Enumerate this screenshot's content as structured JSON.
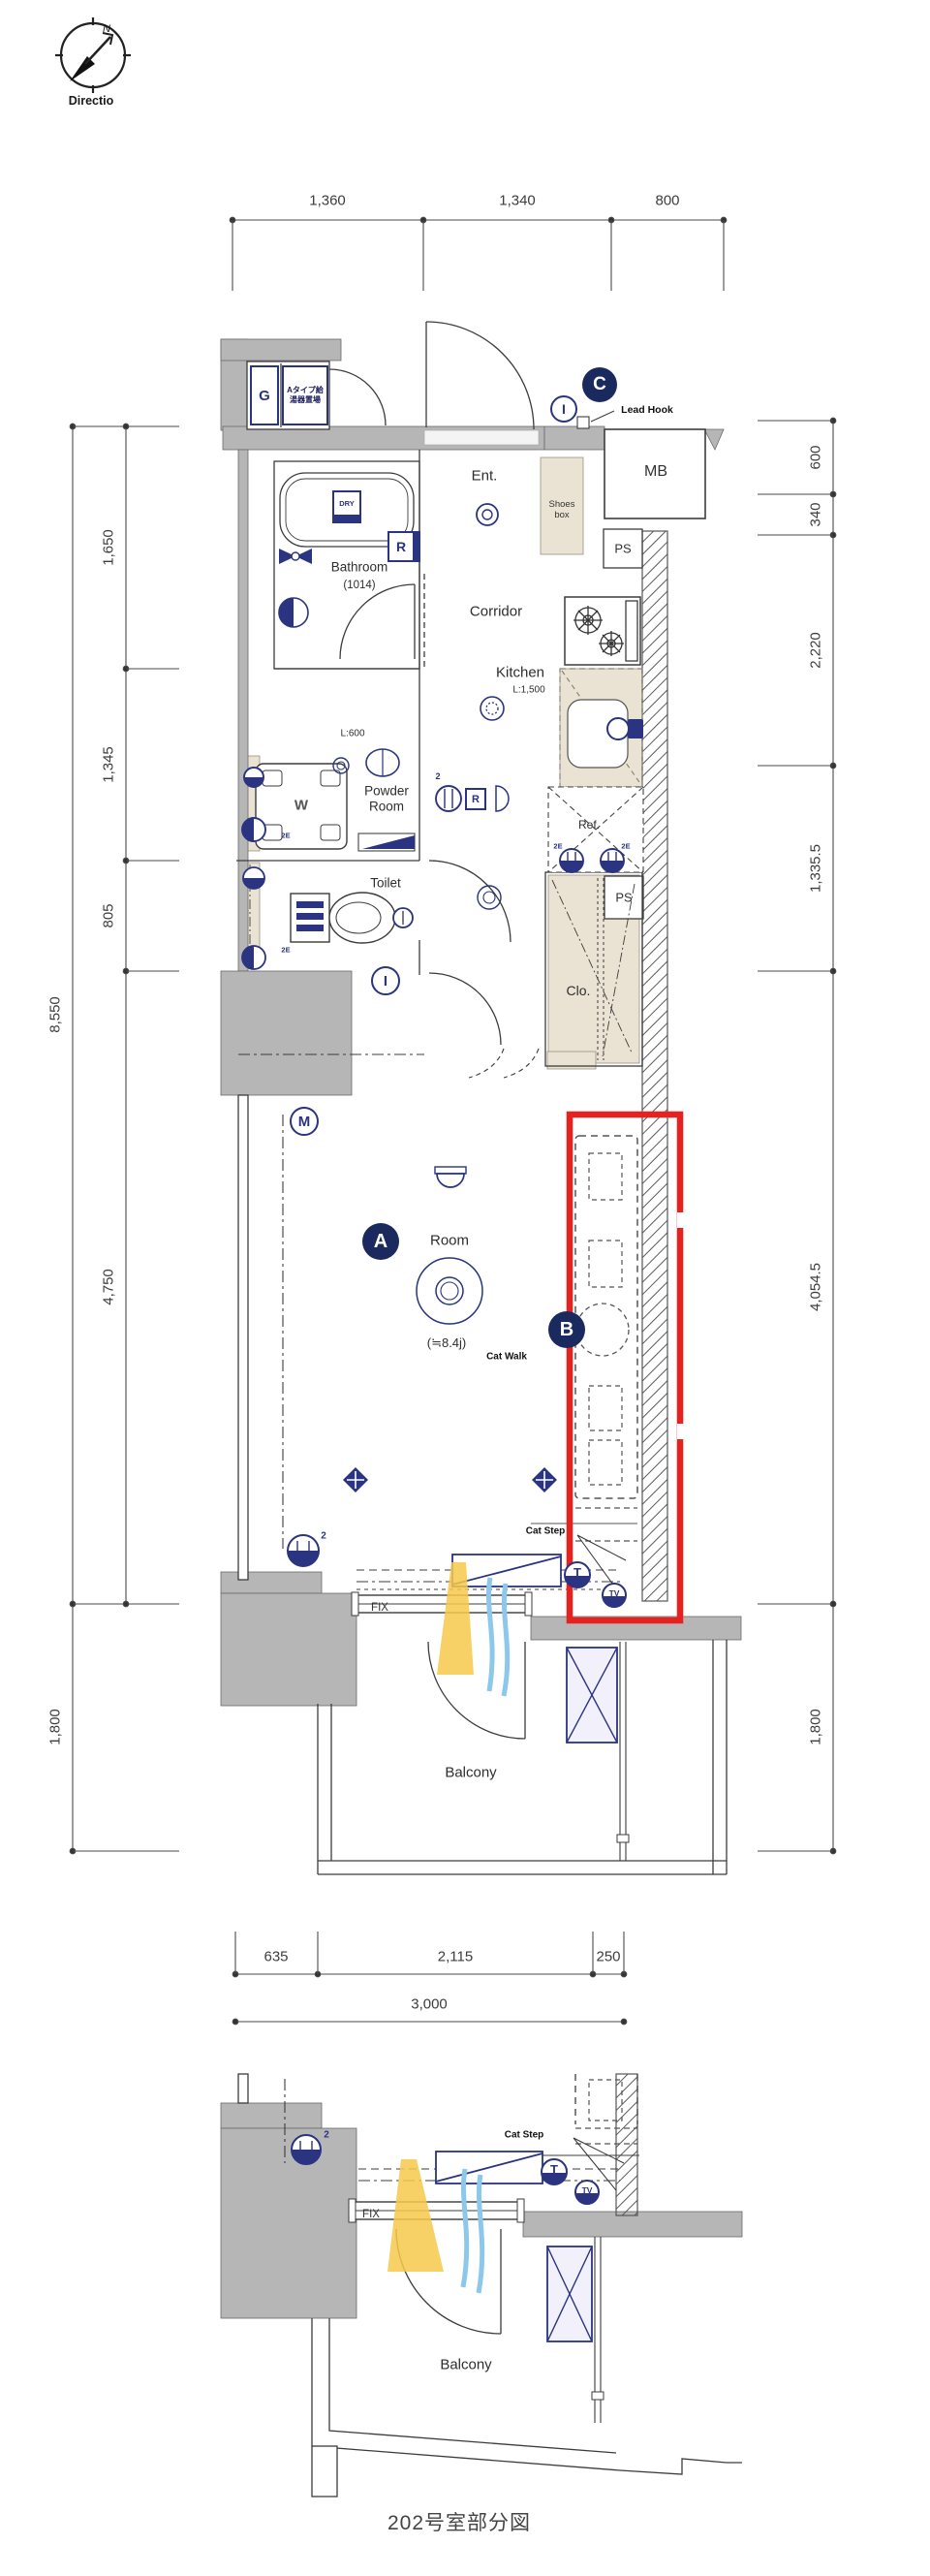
{
  "compass": {
    "label": "Directio",
    "north": "N"
  },
  "dims": {
    "top": [
      "1,360",
      "1,340",
      "800"
    ],
    "left_inner": [
      "1,650",
      "1,345",
      "805",
      "4,750"
    ],
    "left_outer": [
      "8,550",
      "1,800"
    ],
    "right": [
      "600",
      "340",
      "2,220",
      "1,335.5",
      "4,054.5",
      "1,800"
    ],
    "bottom": [
      "635",
      "2,115",
      "250"
    ],
    "bottom_total": "3,000"
  },
  "markers": {
    "a": "A",
    "b": "B",
    "c": "C",
    "m": "M",
    "i": "I",
    "t": "T",
    "tv": "TV"
  },
  "boxes": {
    "g": "G",
    "heater": "Aタイプ給湯器置場",
    "dry": "DRY",
    "r": "R",
    "w": "W",
    "mb": "MB",
    "ps": "PS",
    "e2": "2E",
    "fix": "FIX",
    "sup2": "2"
  },
  "rooms": {
    "ent": "Ent.",
    "shoes": "Shoes box",
    "bathroom": "Bathroom",
    "bathroom_size": "(1014)",
    "corridor": "Corridor",
    "kitchen": "Kitchen",
    "kitchen_level": "L:1,500",
    "washer_level": "L:600",
    "powder": "Powder Room",
    "toilet": "Toilet",
    "ref": "Ref.",
    "clo": "Clo.",
    "room": "Room",
    "room_size": "(≒8.4j)",
    "balcony": "Balcony"
  },
  "annotations": {
    "lead_hook": "Lead Hook",
    "cat_walk": "Cat Walk",
    "cat_step": "Cat Step",
    "caption": "202号室部分図"
  },
  "colors": {
    "fixture_navy": "#2a3480",
    "marker_navy": "#1b2a5e",
    "highlight_red": "#e8211f",
    "wall_gray": "#b6b6b6",
    "fill_beige": "#eae2d3",
    "light_yellow": "#f7c94b",
    "curtain_blue": "#8cc8ec"
  }
}
